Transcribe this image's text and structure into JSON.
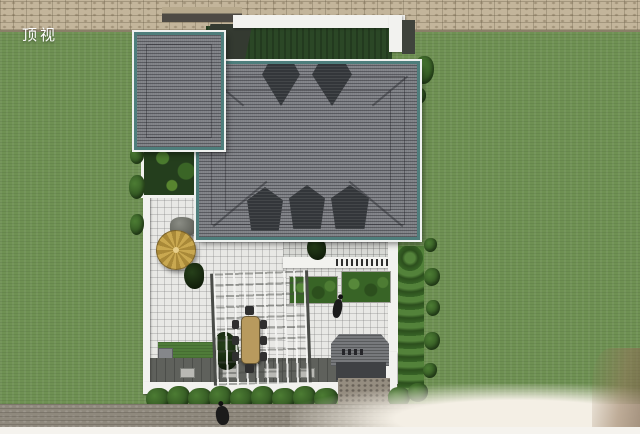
{
  "view_label": "顶视",
  "scene": {
    "type": "architectural top-view 3D rendering",
    "objects": [
      "stone boundary wall",
      "lawn",
      "gray hip roof with teal trim",
      "roof dormers",
      "flat white parapet roof deck",
      "white tiled courtyard",
      "golden patio umbrella",
      "rock",
      "pergola with dining table and chairs",
      "hedge planters",
      "entrance gate canopy",
      "stone entrance apron",
      "hedge row",
      "road",
      "pedestrians"
    ]
  },
  "colors": {
    "grass": "#6F9153",
    "stone_wall": "#C3B59B",
    "stone_wall_shadow": "#8A7F68",
    "roof_shingle": "#7E8085",
    "roof_trim": "#4E7E7C",
    "roof_fascia": "#EFF1EF",
    "dormer": "#33363A",
    "wall_white": "#F2F2EF",
    "backyard_green": "#2B4726",
    "tile_light": "#E8E8E5",
    "tile_terrace": "#D7D8D4",
    "paving_dark": "#5F615C",
    "umbrella_gold": "#C9A850",
    "umbrella_gold_dark": "#A98938",
    "table_wood": "#B89A5E",
    "hedge_green": "#386426",
    "bush_green": "#4C7C33",
    "lawn_green": "#4F7C39",
    "gate_gray": "#77797C",
    "gate_dark": "#3F4144",
    "stone_apron": "#958D80",
    "road": "#8F897D",
    "road_edge": "#F5F3EE",
    "sand": "#F4EFE5",
    "label_color": "#FFFFFF"
  }
}
